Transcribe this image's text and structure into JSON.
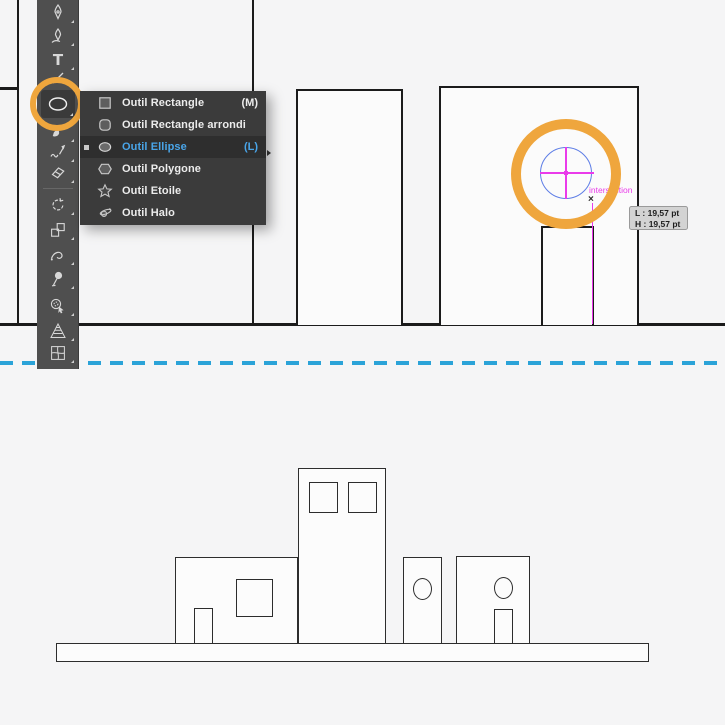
{
  "tools_panel": {
    "active_tool": "ellipse",
    "tools": [
      "pen",
      "curvature",
      "type",
      "line-segment",
      "ellipse",
      "paintbrush",
      "shaper",
      "eraser",
      "rotate",
      "scale",
      "width",
      "puppet-warp",
      "shape-builder",
      "perspective-grid",
      "mesh"
    ]
  },
  "shape_tools_menu": {
    "items": [
      {
        "label": "Outil Rectangle",
        "shortcut": "(M)",
        "icon": "rectangle-icon",
        "selected": false
      },
      {
        "label": "Outil Rectangle arrondi",
        "shortcut": "",
        "icon": "rounded-rectangle-icon",
        "selected": false
      },
      {
        "label": "Outil Ellipse",
        "shortcut": "(L)",
        "icon": "ellipse-icon",
        "selected": true
      },
      {
        "label": "Outil Polygone",
        "shortcut": "",
        "icon": "polygon-icon",
        "selected": false
      },
      {
        "label": "Outil Etoile",
        "shortcut": "",
        "icon": "star-icon",
        "selected": false
      },
      {
        "label": "Outil Halo",
        "shortcut": "",
        "icon": "halo-icon",
        "selected": false
      }
    ]
  },
  "canvas": {
    "smart_guide_label": "intersection",
    "snap_marker": "×",
    "measurement_tooltip": {
      "width": "L : 19,57 pt",
      "height": "H : 19,57 pt"
    }
  },
  "colors": {
    "highlight_orange": "#EFA63D",
    "selected_blue": "#49A5E9",
    "smart_guide_magenta": "#EA3BEA",
    "preview_stroke_blue": "#5D7DE6",
    "divider_blue": "#2BA3D8"
  }
}
